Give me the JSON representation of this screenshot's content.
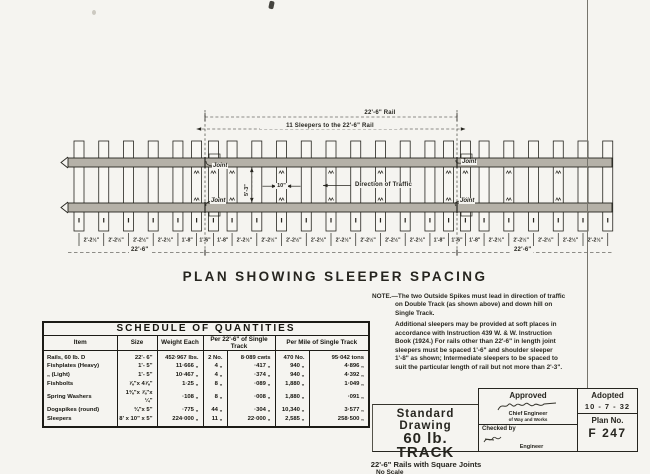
{
  "plan": {
    "title": "PLAN SHOWING SLEEPER SPACING",
    "rail_dim": "22'-6\" Rail",
    "sleepers_dim": "11 Sleepers to the 22'-6\" Rail",
    "joint": "Joint",
    "gauge": "5'-3\"",
    "sleeper_width": "10\"",
    "direction": "Direction of Traffic",
    "rail_len_left": "22'-6\"",
    "rail_len_right": "22'-6\"",
    "gaps_inches": [
      26.5,
      26.5,
      26.5,
      26.5,
      20,
      18,
      20,
      26.5,
      26.5,
      26.5,
      26.5,
      26.5,
      26.5,
      26.5,
      26.5,
      20,
      18,
      20,
      26.5,
      26.5,
      26.5,
      26.5,
      26.5
    ],
    "gap_labels": [
      "2'-2½\"",
      "2'-2½\"",
      "2'-2½\"",
      "2'-2½\"",
      "1'-8\"",
      "1'-6\"",
      "1'-8\"",
      "2'-2½\"",
      "2'-2½\"",
      "2'-2½\"",
      "2'-2½\"",
      "2'-2½\"",
      "2'-2½\"",
      "2'-2½\"",
      "2'-2½\"",
      "1'-8\"",
      "1'-6\"",
      "1'-8\"",
      "2'-2½\"",
      "2'-2½\"",
      "2'-2½\"",
      "2'-2½\"",
      "2'-2½\""
    ]
  },
  "note": {
    "label": "NOTE.—",
    "para1": "The two Outside Spikes must lead in direction of traffic on Double Track (as shown above) and down hill on Single Track.",
    "para2": "Additional sleepers may be provided at soft places in accordance with Instruction 439 W. & W. Instruction Book (1924.) For rails other than 22'-6\" in length joint sleepers must be spaced 1'-6\" and shoulder sleeper 1'-8\" as shown; Intermediate sleepers to be spaced to suit the particular length of rail but not more than 2'-3\"."
  },
  "schedule": {
    "title": "SCHEDULE OF QUANTITIES",
    "columns": [
      "Item",
      "Size",
      "Weight Each",
      "Per 22'-6\" of Single Track",
      "Per Mile of Single Track"
    ],
    "rows": [
      [
        "Rails, 60 lb. D",
        "22'- 6\"",
        "452·967 lbs.",
        "2 No.",
        "8·089 cwts",
        "470 No.",
        "95·042 tons"
      ],
      [
        "Fishplates (Heavy)",
        "1'- 5\"",
        "11·666 „",
        "4 „",
        "·417 „",
        "940 „",
        "4·896 „"
      ],
      [
        "„      (Light)",
        "1'- 5\"",
        "10·467 „",
        "4 „",
        "·374 „",
        "940 „",
        "4·392 „"
      ],
      [
        "Fishbolts",
        "⅞\"x 4⅞\"",
        "1·25 „",
        "8 „",
        "·089 „",
        "1,880 „",
        "1·049 „"
      ],
      [
        "Spring Washers",
        "1⅜\"x ⅞\"x ¼\"",
        "·108 „",
        "8 „",
        "·008 „",
        "1,880 „",
        "·091 „"
      ],
      [
        "Dogspikes (round)",
        "¾\"x 5\"",
        "·775 „",
        "44 „",
        "·304 „",
        "10,340 „",
        "3·577 „"
      ],
      [
        "Sleepers",
        "8' x 10\" x 5\"",
        "224·000 „",
        "11 „",
        "22·000 „",
        "2,585 „",
        "258·500 „"
      ]
    ]
  },
  "title_block": {
    "line1": "Standard Drawing",
    "line2": "60 lb. TRACK",
    "line3": "22'-6\" Rails with Square Joints",
    "line4": "No Scale",
    "approved_label": "Approved",
    "approved_role1": "Chief Engineer",
    "approved_role2": "of Way and Works",
    "checked_label": "Checked by",
    "checked_role": "Engineer",
    "adopted_label": "Adopted",
    "adopted_date": "10 - 7 - 32",
    "plan_no_label": "Plan No.",
    "plan_no": "F 247"
  }
}
